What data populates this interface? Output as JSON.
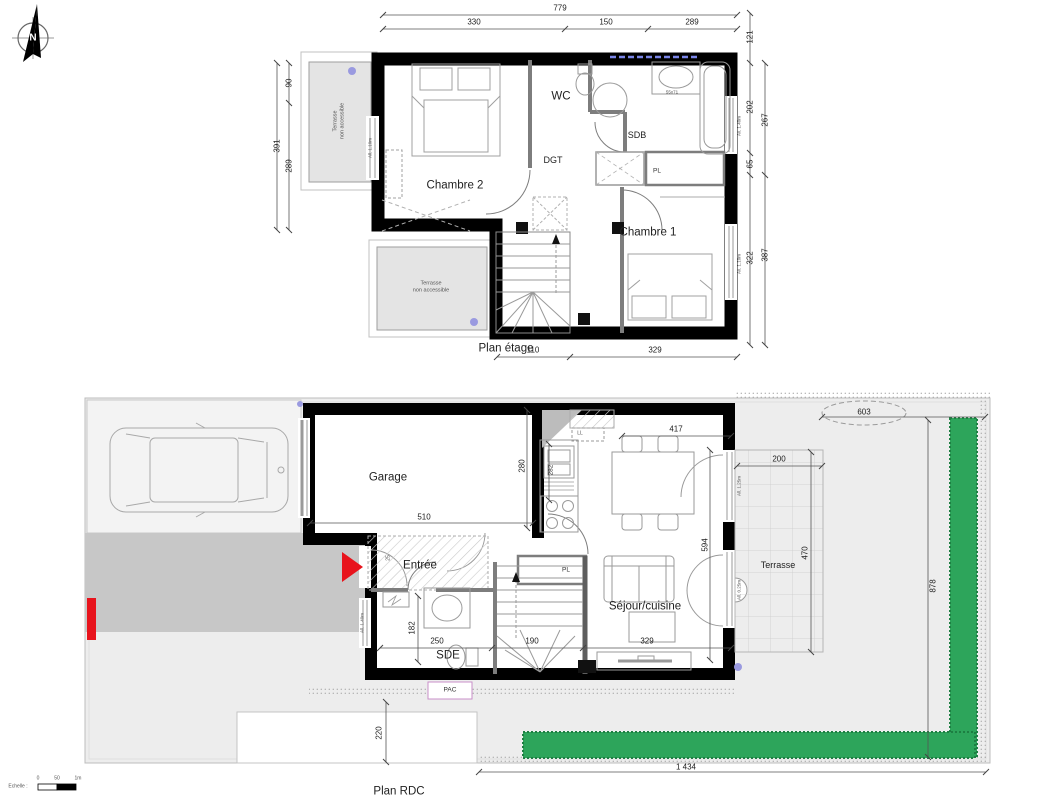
{
  "colors": {
    "wall": "#000000",
    "hedge": "#2da55b",
    "red": "#e8131c",
    "garden": "#ededed",
    "driveway": "#c7c7c7",
    "terrace_fill": "#e4e4e4",
    "accent_dot": "#9a9ae0",
    "window_dash": "#7b86e8"
  },
  "north": {
    "label": "N"
  },
  "scale_bar": {
    "label": "Echelle :",
    "tick0": "0",
    "tick_mid": "50",
    "tick1": "1m"
  },
  "upper": {
    "title": "Plan étage",
    "rooms": {
      "chambre2": "Chambre 2",
      "wc": "WC",
      "sdb": "SDB",
      "dgt": "DGT",
      "chambre1": "Chambre 1",
      "placard": "PL"
    },
    "terraces": {
      "left": "Terrasse\nnon accessible",
      "bottom": "Terrasse\nnon accessible"
    },
    "fixtures": {
      "sink_size": "55x71"
    },
    "window_sills": {
      "chambre2": "All. 1.10m",
      "sdb": "All. 1.40m",
      "chambre1": "All. 1.10m"
    },
    "dims": {
      "total_width": "779",
      "top_left": "330",
      "top_mid": "150",
      "top_right": "289",
      "right_1": "121",
      "right_2": "202",
      "right_3": "267",
      "right_4": "65",
      "right_5": "322",
      "right_6": "387",
      "left_total": "391",
      "left_1": "90",
      "left_2": "289",
      "bottom_1": "110",
      "bottom_2": "329"
    }
  },
  "ground": {
    "title": "Plan RDC",
    "rooms": {
      "garage": "Garage",
      "entree": "Entrée",
      "sde": "SDE",
      "sejour": "Séjour/cuisine",
      "terrasse": "Terrasse",
      "placard": "PL",
      "lave_linge": "LL",
      "pac": "PAC"
    },
    "window_sills": {
      "sde": "All. 1.40m",
      "sejour_1": "All. 1.25m",
      "sejour_2": "All. 0.25m"
    },
    "dims": {
      "garage_width": "510",
      "garage_depth": "280",
      "kitchen": "282",
      "sejour_width": "417",
      "sejour_depth": "594",
      "terrasse_width": "200",
      "terrasse_depth": "470",
      "sde_width": "250",
      "sde_depth": "182",
      "stairs": "190",
      "salon": "329",
      "entry_sill": "25",
      "garden_top": "603",
      "garden_right": "878",
      "garden_bottom": "1 434",
      "garden_left": "220"
    }
  }
}
